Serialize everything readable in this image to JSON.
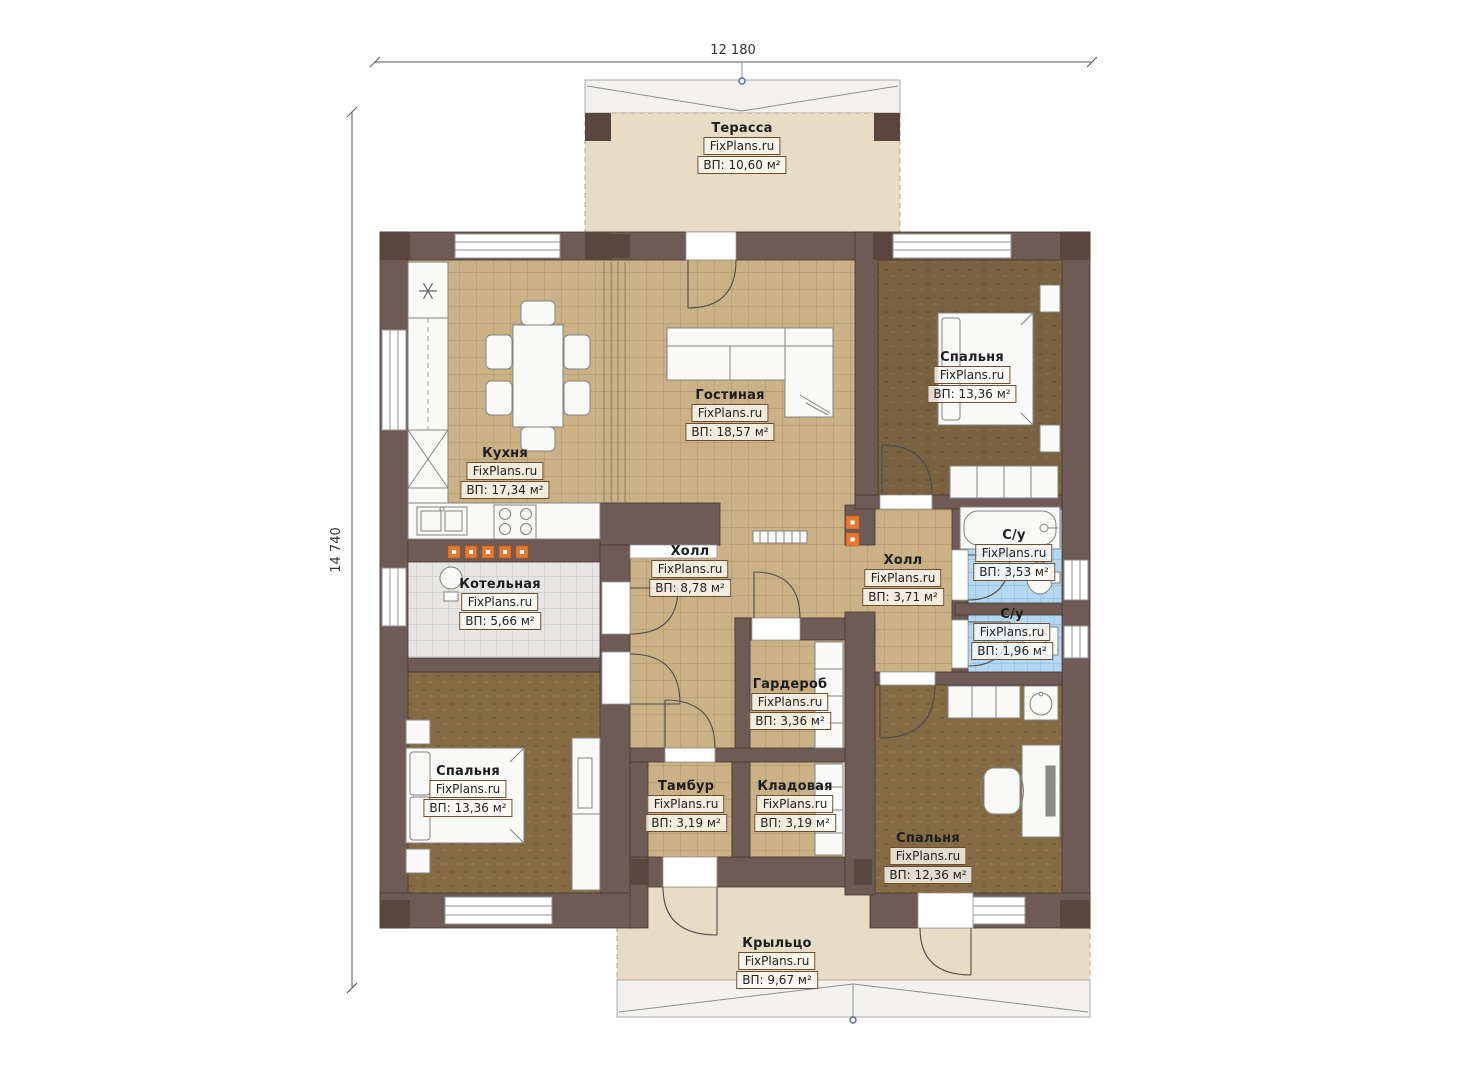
{
  "watermark": "FixPlans.ru",
  "dimensions": {
    "width_label": "12 180",
    "height_label": "14 740"
  },
  "rooms": [
    {
      "name": "Терасса",
      "area": "ВП: 10,60 м²"
    },
    {
      "name": "Кухня",
      "area": "ВП: 17,34 м²"
    },
    {
      "name": "Гостиная",
      "area": "ВП: 18,57 м²"
    },
    {
      "name": "Спальня",
      "area": "ВП: 13,36 м²"
    },
    {
      "name": "Котельная",
      "area": "ВП: 5,66 м²"
    },
    {
      "name": "Холл",
      "area": "ВП: 8,78 м²"
    },
    {
      "name": "Холл",
      "area": "ВП: 3,71 м²"
    },
    {
      "name": "С/у",
      "area": "ВП: 3,53 м²"
    },
    {
      "name": "С/у",
      "area": "ВП: 1,96 м²"
    },
    {
      "name": "Гардероб",
      "area": "ВП: 3,36 м²"
    },
    {
      "name": "Спальня",
      "area": "ВП: 13,36 м²"
    },
    {
      "name": "Тамбур",
      "area": "ВП: 3,19 м²"
    },
    {
      "name": "Кладовая",
      "area": "ВП: 3,19 м²"
    },
    {
      "name": "Спальня",
      "area": "ВП: 12,36 м²"
    },
    {
      "name": "Крыльцо",
      "area": "ВП: 9,67 м²"
    }
  ],
  "colors": {
    "wall": "#6f5b56",
    "wall_pillar": "#5a463f",
    "tile_floor": "#cbb186",
    "wood_floor": "#82694a",
    "bathroom_tile": "#b4d8f3",
    "boiler_tile": "#e7e6e4",
    "outdoor_floor": "#e8dcc4",
    "accent_orange": "#e8782f",
    "marker_blue": "#5566bb"
  }
}
